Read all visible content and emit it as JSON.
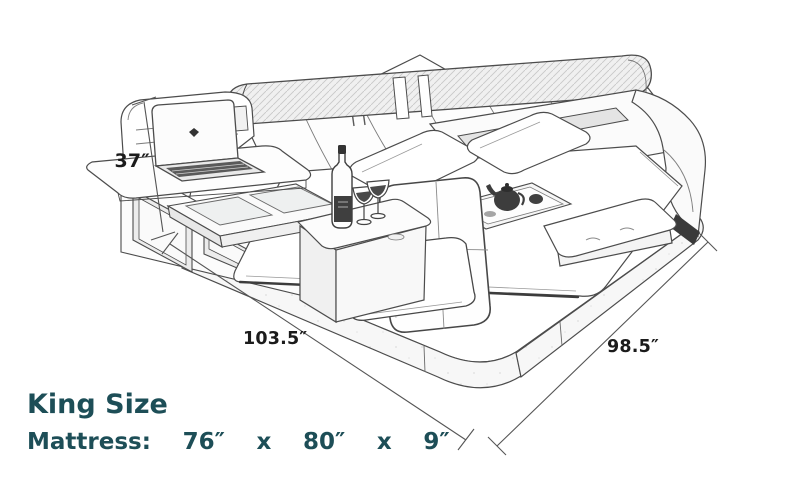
{
  "diagram": {
    "caption": {
      "title": "King Size",
      "spec": "Mattress:  76″  x  80″  x  9″"
    },
    "dimensions": {
      "height": "37″",
      "width": "103.5″",
      "depth": "98.5″"
    },
    "colors": {
      "caption_text": "#1d4e57",
      "sketch_line": "#4c4c4c",
      "dimension_line": "#555555",
      "background": "#ffffff"
    },
    "illustration": {
      "type": "pencil-sketch-isometric",
      "subject": "multifunctional king size smart bed",
      "elements": [
        "platform-base",
        "headboard",
        "bolster-cushion",
        "storage-tower",
        "open-shelves",
        "glass-console",
        "laptop-desk",
        "laptop",
        "pillow-left",
        "pillow-right",
        "mattress-surface",
        "side-rail",
        "tea-tray",
        "lounge-chair",
        "seat-cushion",
        "wine-table",
        "wine-bottle",
        "wine-glasses",
        "foot-bench"
      ]
    }
  }
}
